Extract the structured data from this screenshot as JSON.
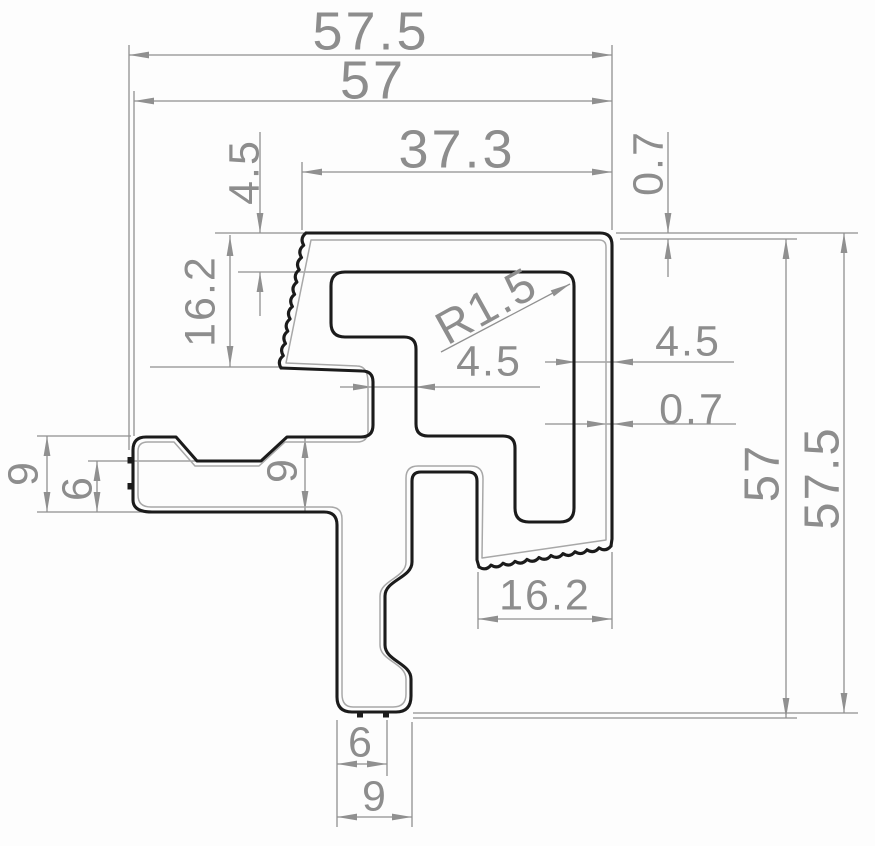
{
  "drawing": {
    "type": "technical-cross-section",
    "subject": "aluminium frame extrusion profile with dimension annotations",
    "colors": {
      "profile": "#1b1b1b",
      "dimension": "#909090",
      "inner_wall": "#a8a8a8",
      "background": "#fdfdfd"
    },
    "dimensions": {
      "overall_width_outer": "57.5",
      "overall_width": "57",
      "top_face_width": "37.3",
      "top_wall_thickness": "4.5",
      "left_grip_height": "16.2",
      "top_skin_thickness": "0.7",
      "cavity_corner_radius": "R1.5",
      "center_web_thickness": "4.5",
      "right_wall_thickness": "4.5",
      "right_skin_thickness": "0.7",
      "arm_height": "9",
      "arm_lip_height": "6",
      "arm_mid_height": "9",
      "overall_height": "57",
      "overall_height_outer": "57.5",
      "bottom_grip_width": "16.2",
      "leg_bottom_inner_width": "6",
      "leg_bottom_width": "9"
    }
  }
}
